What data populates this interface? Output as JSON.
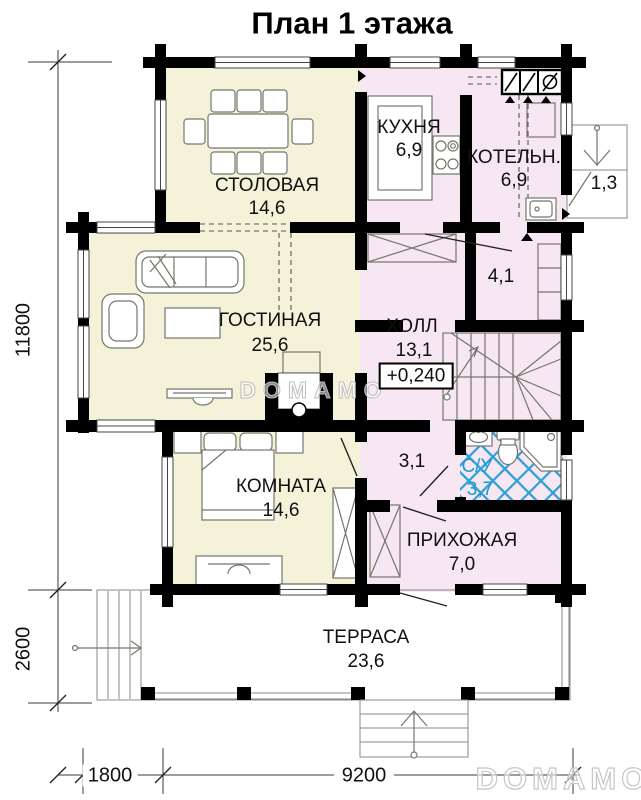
{
  "title": "План 1 этажа",
  "watermark": {
    "center": "DOMAMO",
    "corner": "DOMAMO"
  },
  "rooms": {
    "dining": {
      "name": "СТОЛОВАЯ",
      "area": "14,6"
    },
    "kitchen": {
      "name": "КУХНЯ",
      "area": "6,9"
    },
    "boiler": {
      "name": "КОТЕЛЬН.",
      "area": "6,9"
    },
    "porch": {
      "area": "1,3"
    },
    "living": {
      "name": "ГОСТИНАЯ",
      "area": "25,6"
    },
    "hall": {
      "name": "ХОЛЛ",
      "area": "13,1",
      "elevation": "+0,240"
    },
    "tambour": {
      "area": "4,1"
    },
    "bedroom": {
      "name": "КОМНАТА",
      "area": "14,6"
    },
    "corridor": {
      "area": "3,1"
    },
    "bathroom": {
      "name": "С/У",
      "area": "3,7"
    },
    "entry": {
      "name": "ПРИХОЖАЯ",
      "area": "7,0"
    },
    "terrace": {
      "name": "ТЕРРАСА",
      "area": "23,6"
    }
  },
  "dimensions": {
    "house_height": "11800",
    "terrace_depth": "2600",
    "bay_width": "1800",
    "house_width": "9200"
  },
  "colors": {
    "wall": "#000000",
    "living_zone": "#f4f3d9",
    "service_zone": "#f7e7f2",
    "outdoor": "#d9e7d9",
    "tile_accent": "#2aa0d4",
    "bath_label": "#1d9ad0"
  }
}
